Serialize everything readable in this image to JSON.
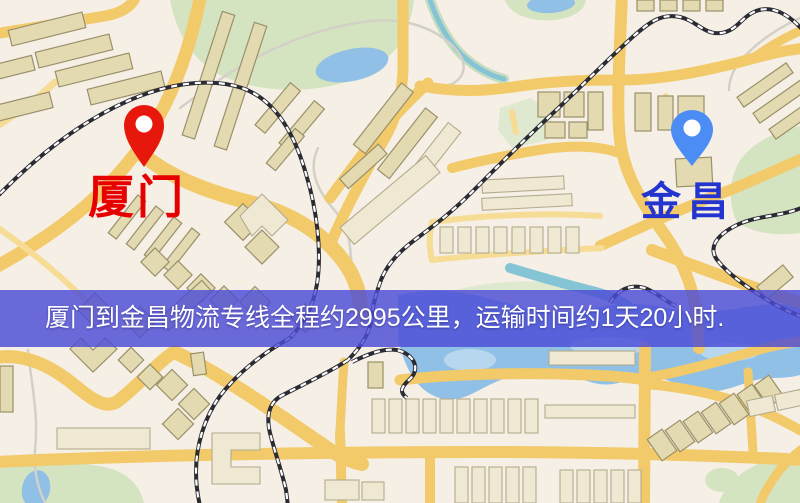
{
  "map": {
    "origin": {
      "label": "厦门",
      "pin": "red-map-pin",
      "pin_color": "#e8170c",
      "label_color": "#e60000"
    },
    "destination": {
      "label": "金昌",
      "pin": "blue-map-pin",
      "pin_color": "#4c8cf5",
      "label_color": "#2334cf"
    }
  },
  "banner": {
    "text": "厦门到金昌物流专线全程约2995公里，运输时间约1天20小时.",
    "text_color": "#ffffff",
    "background_color": "#4c4cd6"
  },
  "theme": {
    "map_background": "#f5efe6",
    "road": "#f2ca6a",
    "road_light": "#f6dc95",
    "building_fill": "#e4dab2",
    "building_fill_light": "#efe9d3",
    "building_stroke": "#9a9069",
    "park": "#d4e3c0",
    "park_light": "#dfe9cf",
    "water": "#90c0e6",
    "water_light": "#b7d7ee",
    "stream": "#84c4d5",
    "railway": "#2b2b33",
    "path": "#d3d0c6"
  }
}
